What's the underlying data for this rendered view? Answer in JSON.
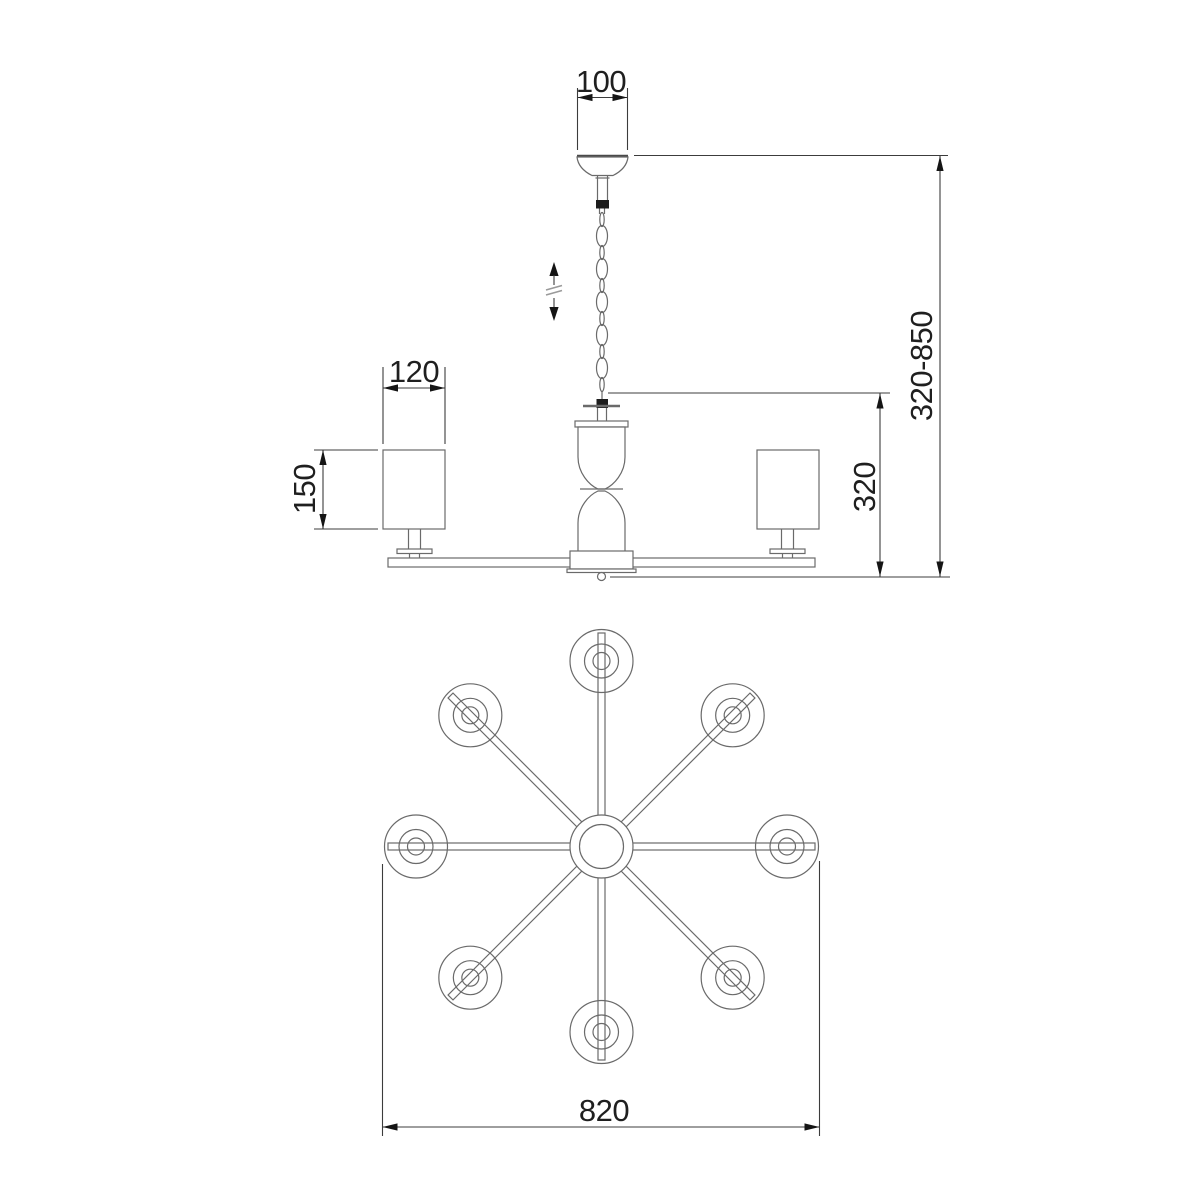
{
  "page": {
    "background": "#ffffff"
  },
  "dimensions": {
    "canopy_width": "100",
    "shade_width": "120",
    "shade_height": "150",
    "frame_drop": "320",
    "overall_height_range": "320-850",
    "overall_diameter": "820"
  },
  "icons": {
    "height_adjust": "up-down-arrows"
  },
  "colors": {
    "line": "#6a6a6a",
    "dimension_line": "#3c3c3c",
    "text": "#1f1f1f",
    "fill_dark": "#1d1d1d",
    "background": "#ffffff"
  }
}
